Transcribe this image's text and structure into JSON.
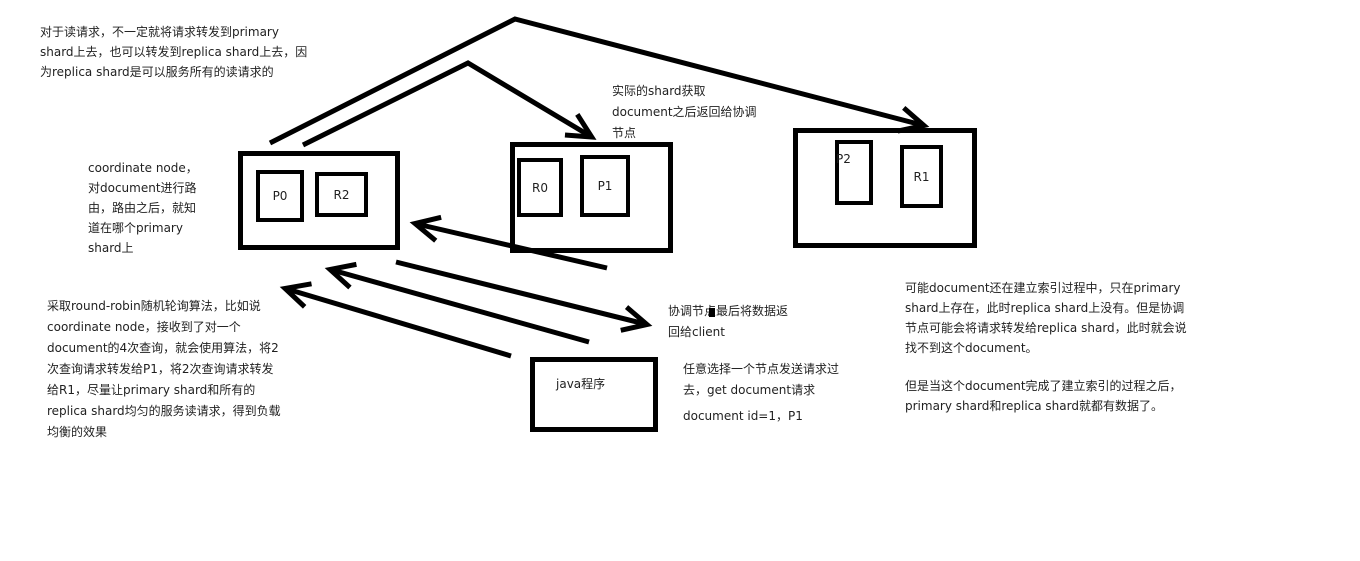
{
  "colors": {
    "background": "#ffffff",
    "ink": "#000000",
    "text": "#1f1f1f"
  },
  "notes": {
    "read_request": {
      "lines": [
        "对于读请求，不一定就将请求转发到primary",
        "shard上去，也可以转发到replica shard上去，因",
        "为replica shard是可以服务所有的读请求的"
      ]
    },
    "coordinate_node": {
      "lines": [
        "coordinate node，",
        "对document进行路",
        "由，路由之后，就知",
        "道在哪个primary",
        "shard上"
      ]
    },
    "actual_shard": {
      "lines": [
        "实际的shard获取",
        "document之后返回给协调",
        "节点"
      ]
    },
    "round_robin": {
      "lines": [
        "采取round-robin随机轮询算法，比如说",
        "coordinate node，接收到了对一个",
        "document的4次查询，就会使用算法，将2",
        "次查询请求转发给P1，将2次查询请求转发",
        "给R1，尽量让primary shard和所有的",
        "replica shard均匀的服务读请求，得到负载",
        "均衡的效果"
      ]
    },
    "return_client": {
      "lines": [
        "协调节点最后将数据返",
        "回给client"
      ]
    },
    "pick_node": {
      "lines": [
        "任意选择一个节点发送请求过",
        "去，get document请求"
      ]
    },
    "doc_id": {
      "text": "document id=1，P1"
    },
    "replica_sync": {
      "para1": [
        "可能document还在建立索引过程中，只在primary",
        "shard上存在，此时replica shard上没有。但是协调",
        "节点可能会将请求转发给replica shard，此时就会说",
        "找不到这个document。"
      ],
      "para2": [
        "但是当这个document完成了建立索引的过程之后，",
        "primary shard和replica shard就都有数据了。"
      ]
    }
  },
  "nodes": [
    {
      "shards": [
        "P0",
        "R2"
      ]
    },
    {
      "shards": [
        "R0",
        "P1"
      ]
    },
    {
      "shards": [
        "P2",
        "R1"
      ]
    }
  ],
  "java_box": {
    "label": "java程序"
  }
}
